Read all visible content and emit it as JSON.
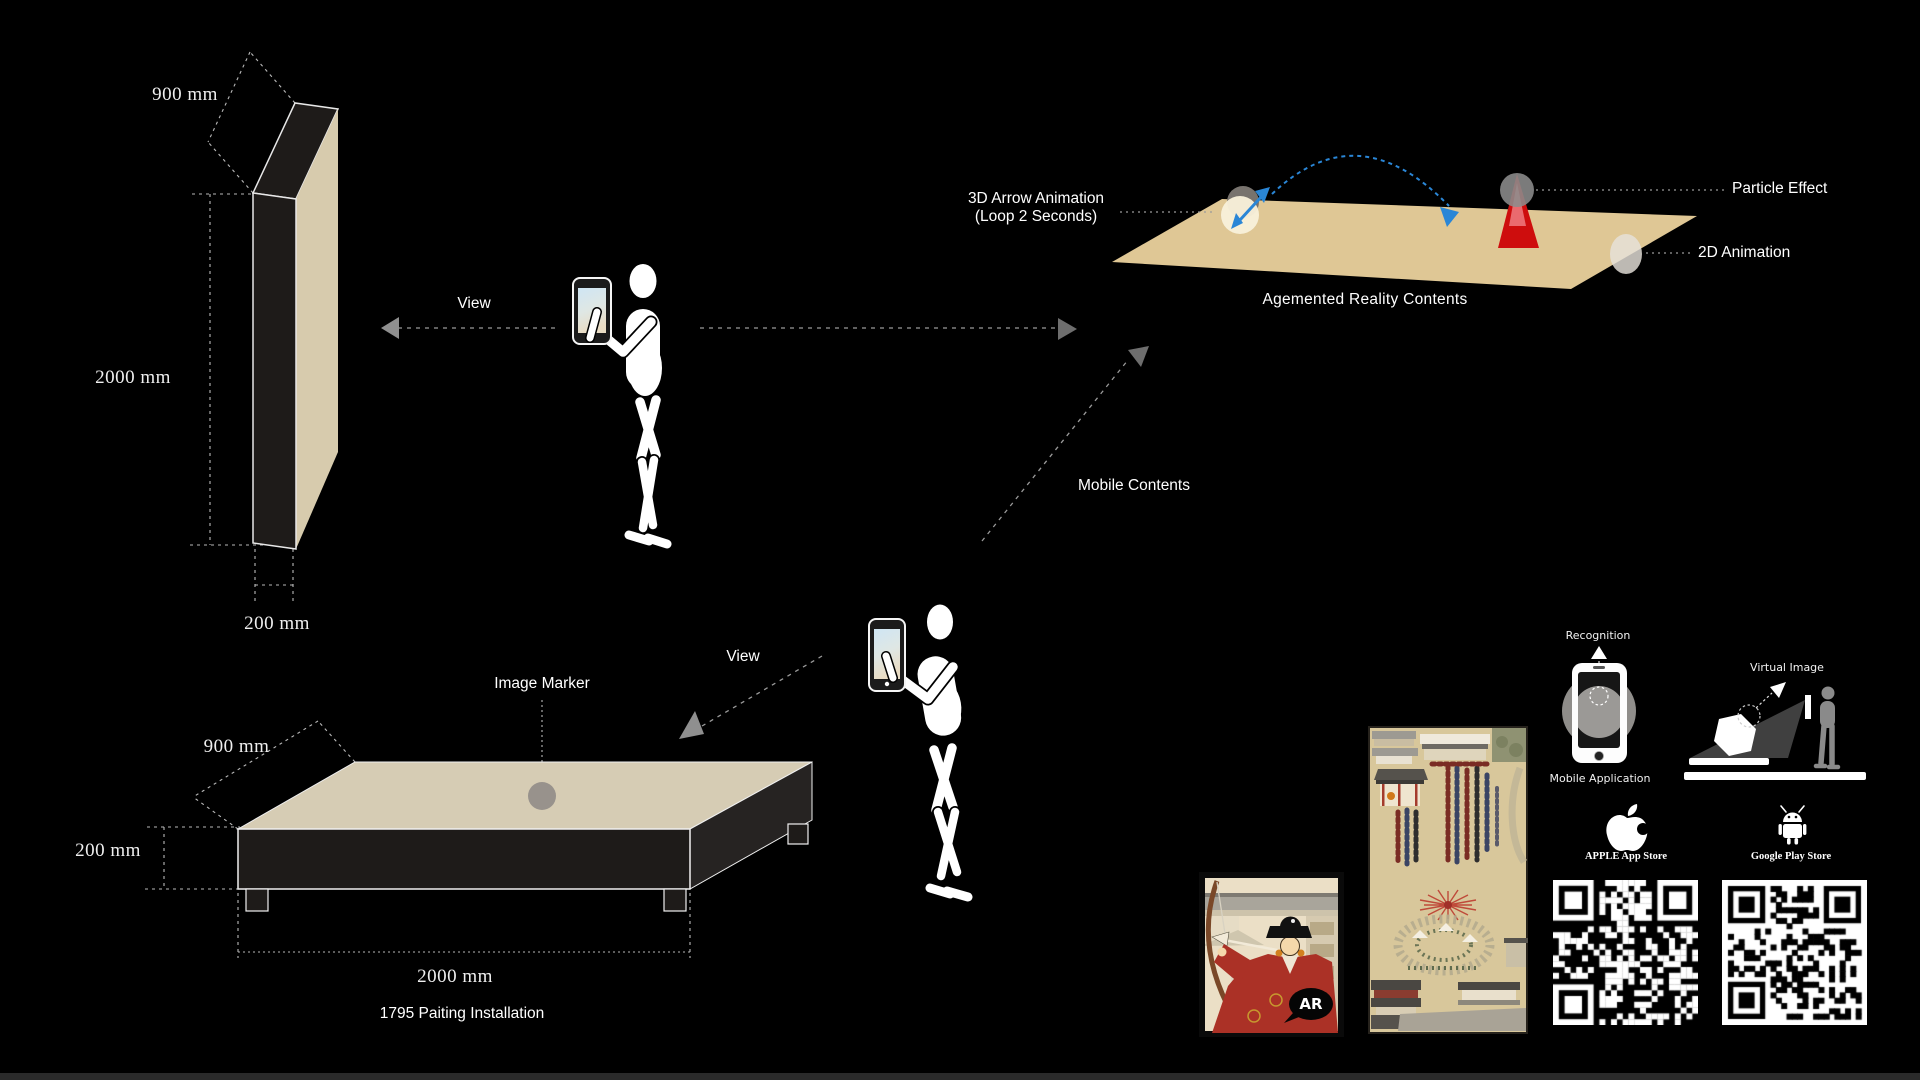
{
  "colors": {
    "background": "#000000",
    "panel_side_beige": "#d7cbad",
    "platform_top_beige": "#d6ccb4",
    "ar_plane_beige": "#dfc795",
    "dark_face": "#1e1b19",
    "arrow_blue": "#2a86d6",
    "particle_red": "#ce0d0d"
  },
  "panel": {
    "depth": "900 mm",
    "height": "2000 mm",
    "thickness": "200 mm"
  },
  "platform": {
    "depth": "900 mm",
    "height": "200 mm",
    "width": "2000 mm",
    "caption": "1795 Paiting Installation",
    "marker": "Image Marker"
  },
  "viewers": {
    "view_top": "View",
    "view_bottom": "View",
    "mobile_contents": "Mobile Contents"
  },
  "ar": {
    "arrow_line1": "3D Arrow Animation",
    "arrow_line2": "(Loop 2 Seconds)",
    "particle": "Particle Effect",
    "anim2d": "2D Animation",
    "caption": "Agemented Reality Contents"
  },
  "apps": {
    "recognition": "Recognition",
    "mobile_application": "Mobile Application",
    "virtual_image": "Virtual Image",
    "apple_store": "APPLE App Store",
    "google_store": "Google Play Store",
    "ar_badge": "AR"
  }
}
